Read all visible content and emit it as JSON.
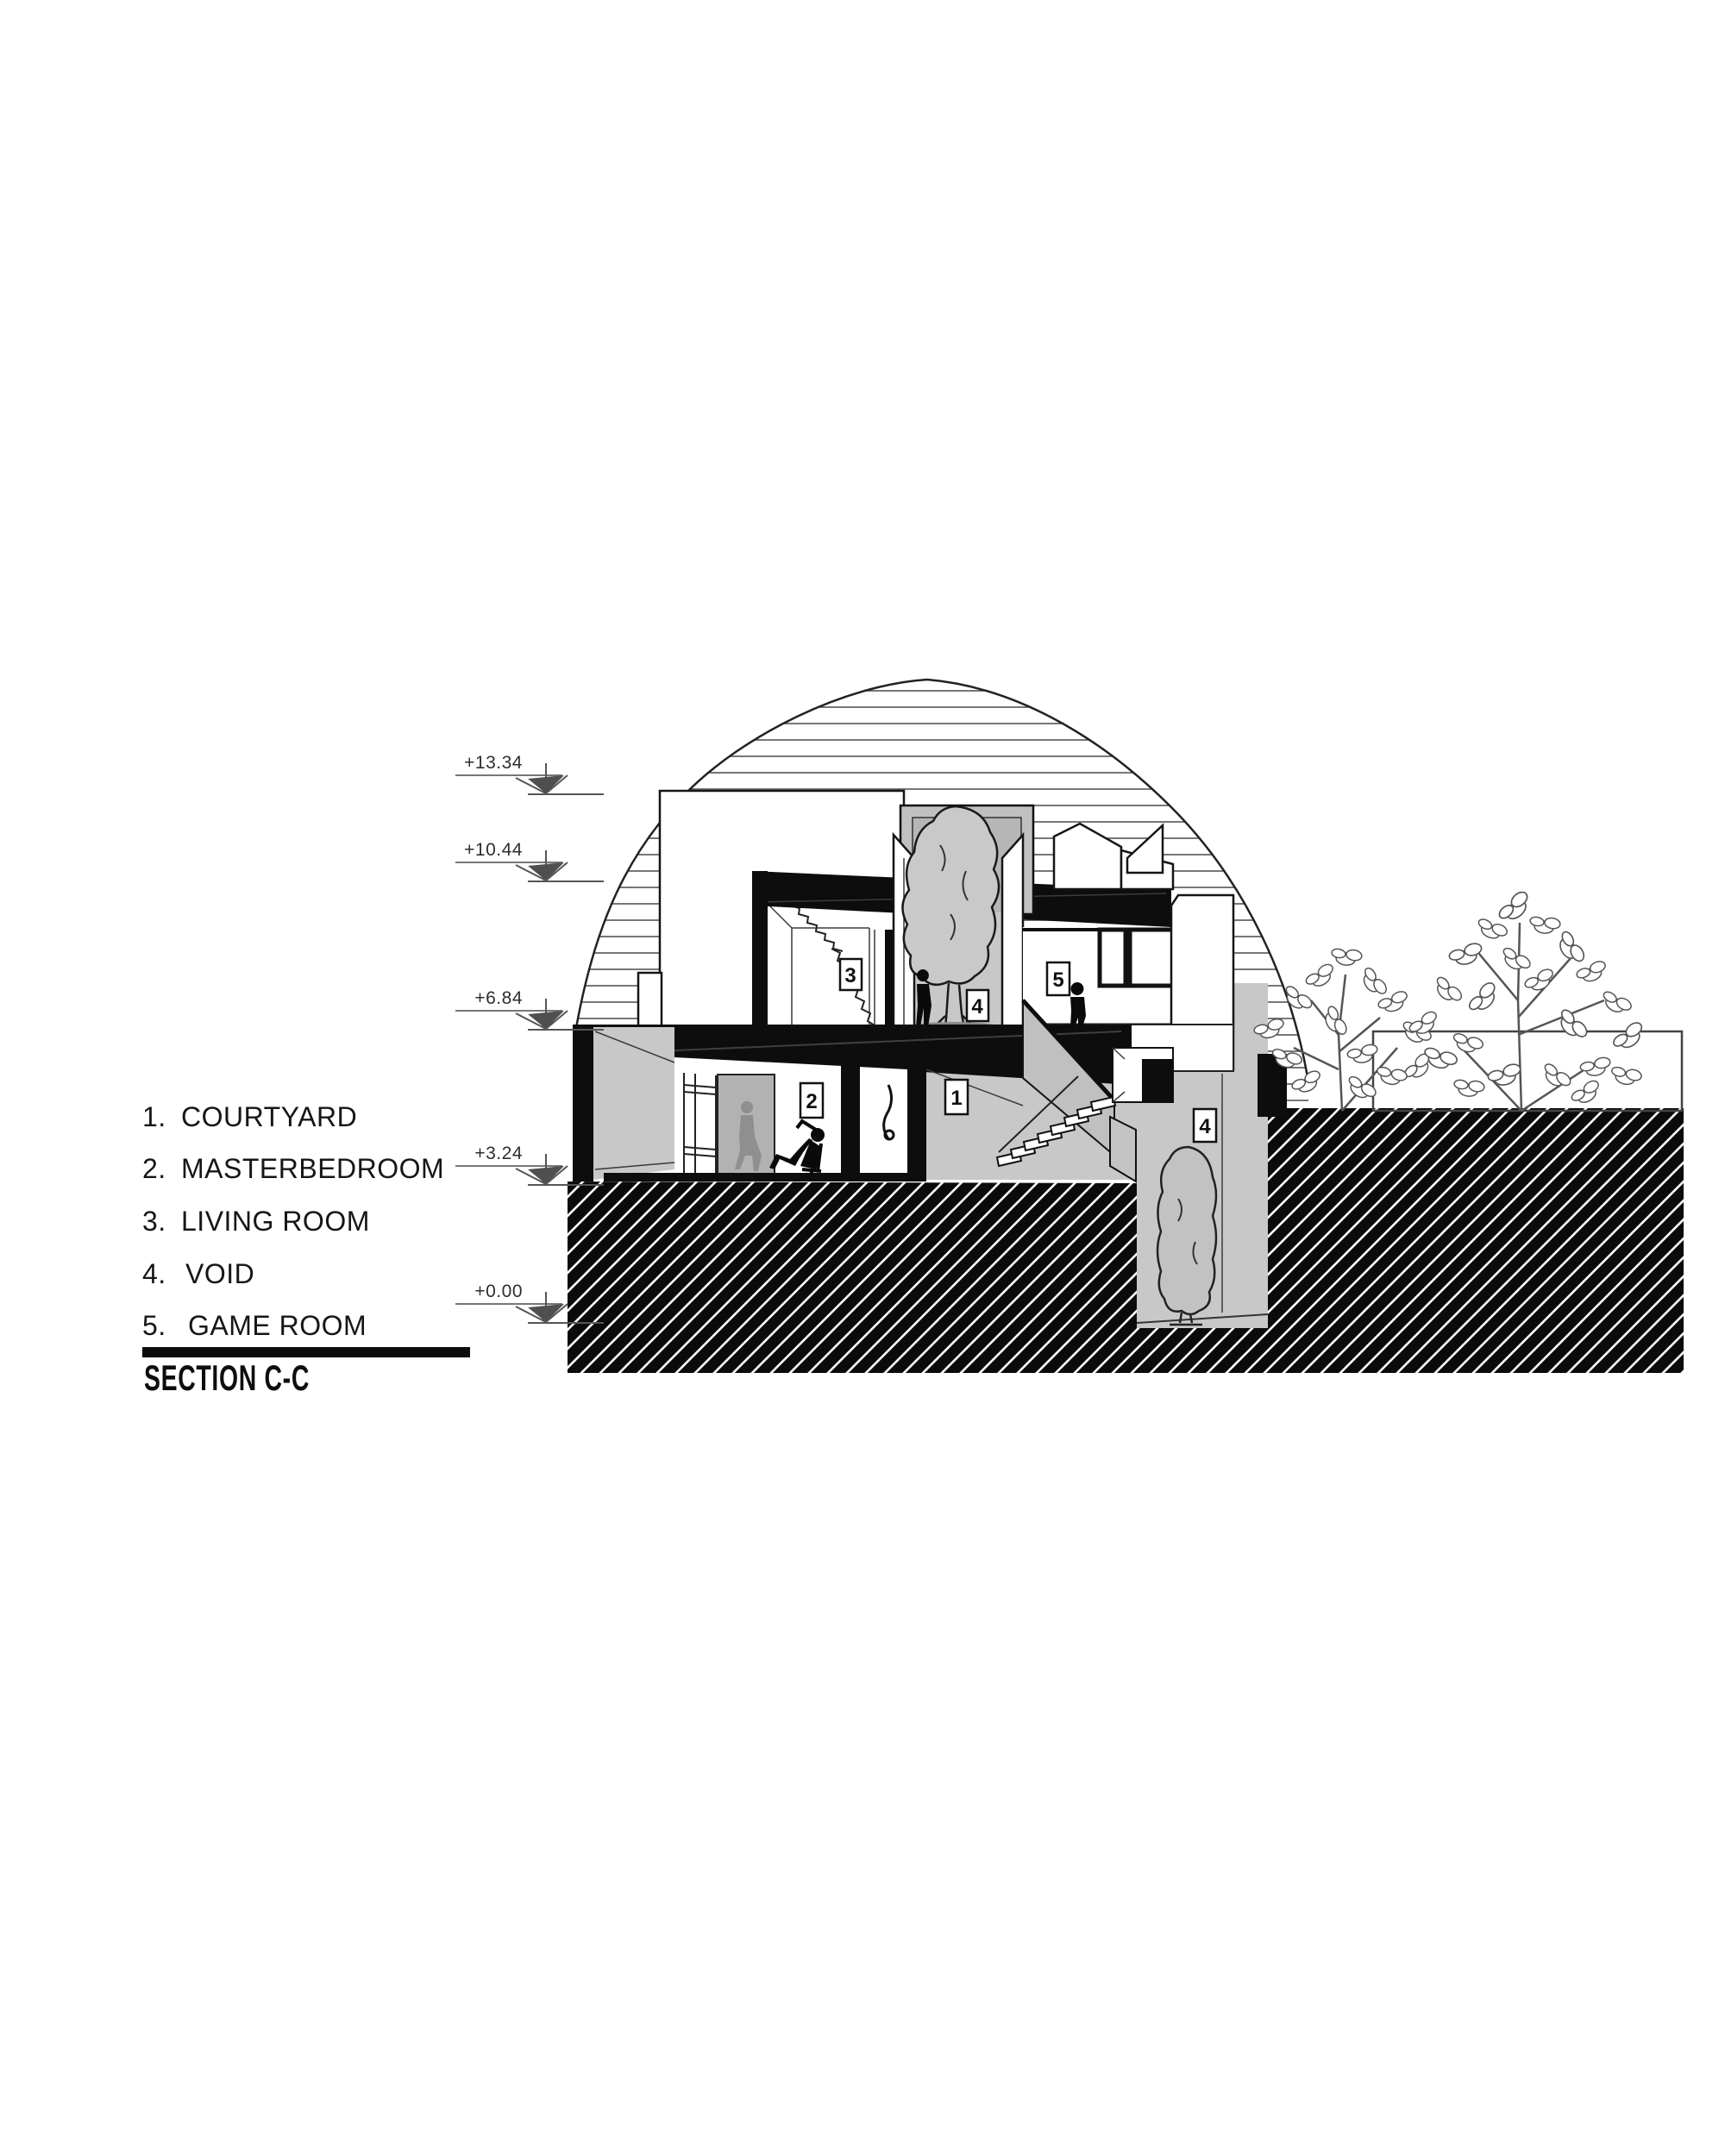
{
  "title": {
    "label": "SECTION C-C"
  },
  "legend": {
    "items": [
      {
        "num": "1.",
        "label": "COURTYARD"
      },
      {
        "num": "2.",
        "label": "MASTERBEDROOM"
      },
      {
        "num": "3.",
        "label": "LIVING ROOM"
      },
      {
        "num": "4.",
        "label": "VOID"
      },
      {
        "num": "5.",
        "label": "GAME ROOM"
      }
    ]
  },
  "elevations": {
    "marks": [
      {
        "value": "+13.34"
      },
      {
        "value": "+10.44"
      },
      {
        "value": "+6.84"
      },
      {
        "value": "+3.24"
      },
      {
        "value": "+0.00"
      }
    ]
  },
  "room_tags": {
    "courtyard": "1",
    "masterbedroom": "2",
    "living_room": "3",
    "void": "4",
    "game_room": "5"
  },
  "colors": {
    "ink": "#0d0d0d",
    "line_gray": "#4a4a4a",
    "surface_gray": "#c8c8c8",
    "door_gray": "#b2b2b2",
    "figure_gray": "#8f8f8f",
    "hatch_black": "#0b0b0b",
    "paper": "#ffffff"
  }
}
